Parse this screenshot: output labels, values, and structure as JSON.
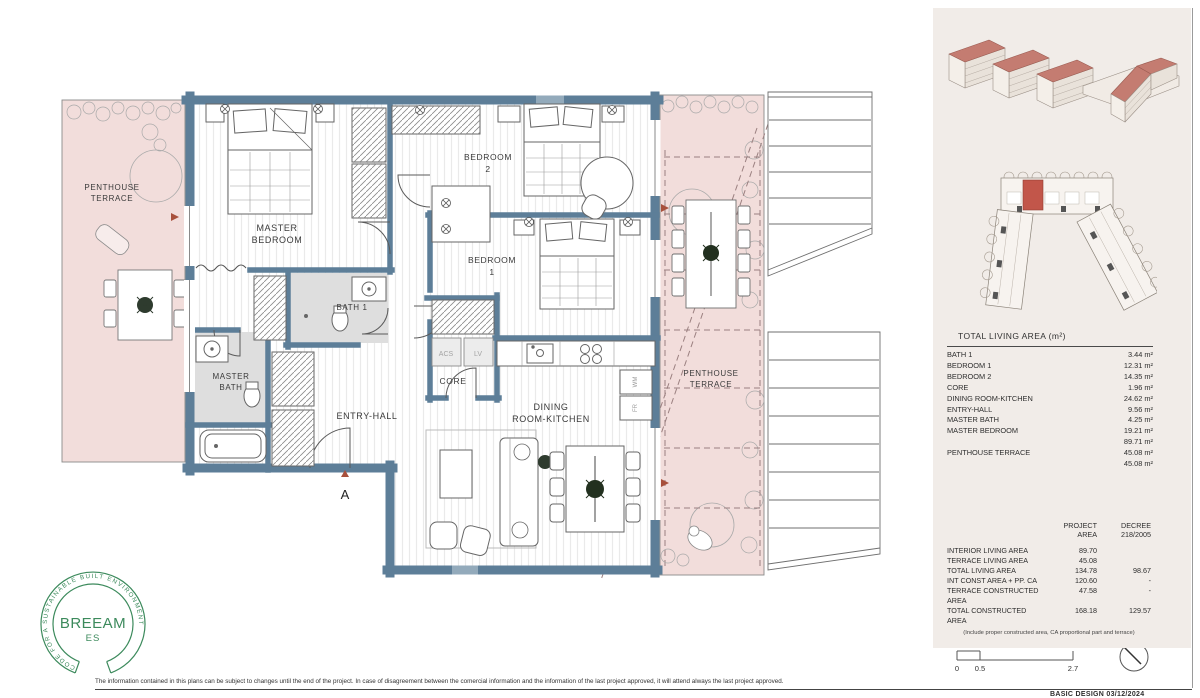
{
  "plan": {
    "rooms": {
      "terrace_left_line1": "PENTHOUSE",
      "terrace_left_line2": "TERRACE",
      "terrace_right_line1": "PENTHOUSE",
      "terrace_right_line2": "TERRACE",
      "master_bedroom_line1": "MASTER",
      "master_bedroom_line2": "BEDROOM",
      "bedroom2_line1": "BEDROOM",
      "bedroom2_line2": "2",
      "bedroom1_line1": "BEDROOM",
      "bedroom1_line2": "1",
      "bath1": "BATH 1",
      "master_bath_line1": "MASTER",
      "master_bath_line2": "BATH",
      "entry_hall": "ENTRY-HALL",
      "core": "CORE",
      "dining_line1": "DINING",
      "dining_line2": "ROOM-KITCHEN",
      "acs": "ACS",
      "lv": "LV",
      "wm": "WM",
      "fr": "FR",
      "section_marker": "A"
    }
  },
  "living_table": {
    "title": "TOTAL LIVING AREA (m²)",
    "rows": [
      {
        "label": "BATH 1",
        "value": "3.44 m²"
      },
      {
        "label": "BEDROOM 1",
        "value": "12.31 m²"
      },
      {
        "label": "BEDROOM 2",
        "value": "14.35 m²"
      },
      {
        "label": "CORE",
        "value": "1.96 m²"
      },
      {
        "label": "DINING ROOM-KITCHEN",
        "value": "24.62 m²"
      },
      {
        "label": "ENTRY-HALL",
        "value": "9.56 m²"
      },
      {
        "label": "MASTER BATH",
        "value": "4.25 m²"
      },
      {
        "label": "MASTER BEDROOM",
        "value": "19.21 m²"
      },
      {
        "label": "",
        "value": "89.71 m²"
      },
      {
        "label": "PENTHOUSE TERRACE",
        "value": "45.08 m²"
      },
      {
        "label": "",
        "value": "45.08 m²"
      }
    ]
  },
  "area_table": {
    "header_col1_line1": "PROJECT",
    "header_col1_line2": "AREA",
    "header_col2_line1": "DECREE",
    "header_col2_line2": "218/2005",
    "rows": [
      {
        "label": "INTERIOR LIVING AREA",
        "project": "89.70",
        "decree": ""
      },
      {
        "label": "TERRACE LIVING AREA",
        "project": "45.08",
        "decree": ""
      },
      {
        "label": "TOTAL LIVING AREA",
        "project": "134.78",
        "decree": "98.67"
      },
      {
        "label": "INT CONST AREA + PP. CA",
        "project": "120.60",
        "decree": "-"
      },
      {
        "label": "TERRACE CONSTRUCTED AREA",
        "project": "47.58",
        "decree": "-"
      },
      {
        "label": "TOTAL CONSTRUCTED AREA",
        "project": "168.18",
        "decree": "129.57"
      }
    ],
    "footnote": "(Include proper constructed area, CA proportional part and terrace)"
  },
  "scale_bar": {
    "tick0": "0",
    "tick1": "0.5",
    "tick2": "2.7"
  },
  "breeam": {
    "arc_text": "CODE FOR A SUSTAINABLE BUILT ENVIRONMENT",
    "name": "BREEAM",
    "sub": "ES"
  },
  "footer": {
    "disclaimer": "The information contained in this plans can be subject to changes until the end of the project. In case of disagreement between the comercial information and the information of the last project approved, it will attend always the last project approved.",
    "stamp": "BASIC DESIGN 03/12/2024"
  },
  "colors": {
    "wall": "#5d7e98",
    "terrace_pink": "#f2dddb",
    "roof_red": "#c47c71",
    "panel_beige": "#f1ece8",
    "breeam_green": "#3c8a5c",
    "marker_red": "#a8503c"
  }
}
